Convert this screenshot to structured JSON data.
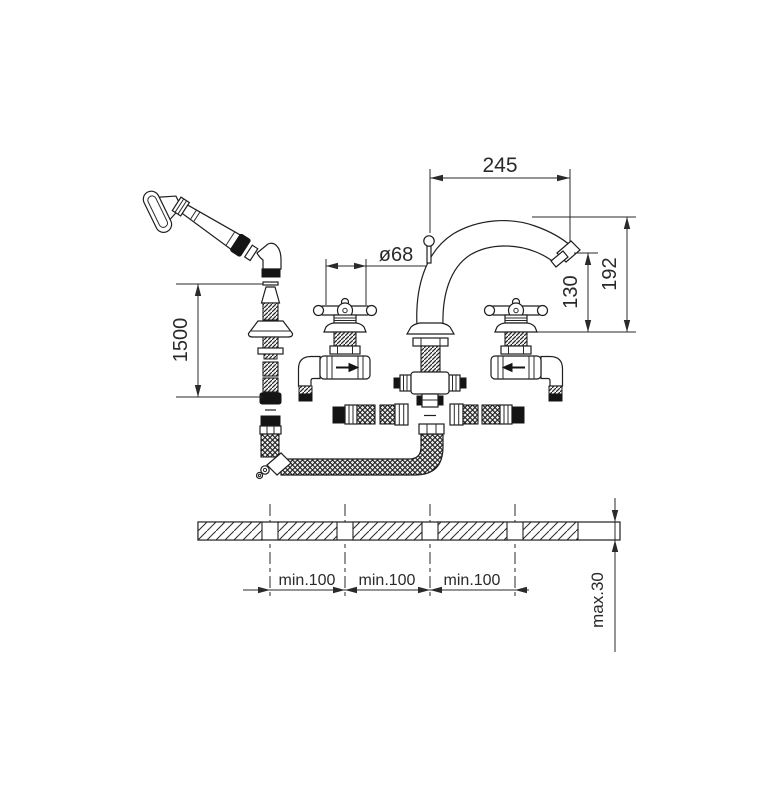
{
  "drawing": {
    "kind": "faucet-installation-dimension-drawing",
    "background": "#ffffff",
    "line_color": "#1f1f1f"
  },
  "labels": {
    "spout_reach": "245",
    "handle_diameter": "ø68",
    "spout_outlet_height": "130",
    "spout_top_height": "192",
    "hose_length": "1500",
    "hole_spacing_1": "min.100",
    "hole_spacing_2": "min.100",
    "hole_spacing_3": "min.100",
    "deck_thickness": "max.30"
  }
}
